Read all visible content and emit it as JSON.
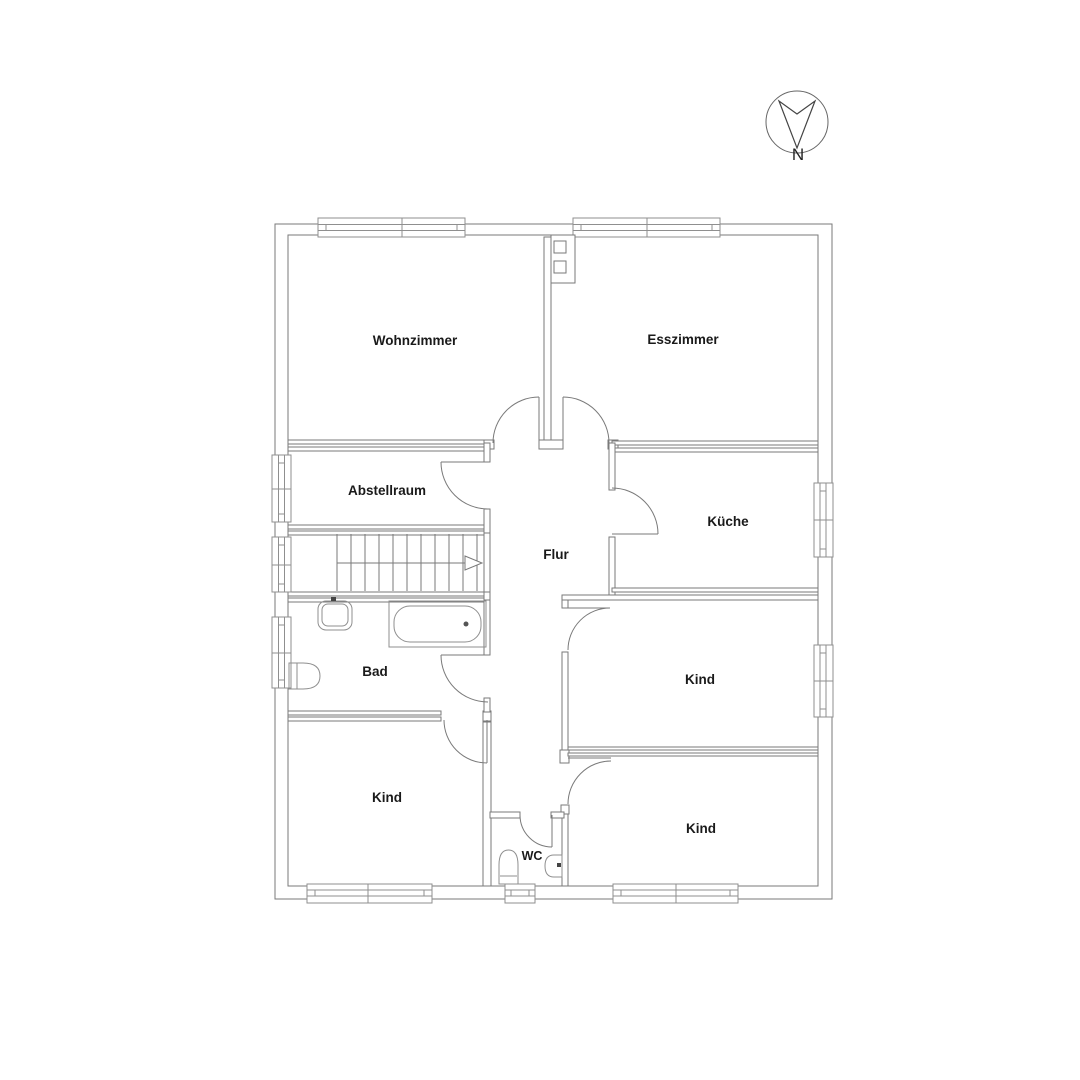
{
  "plan": {
    "rooms": [
      {
        "id": "wohnzimmer",
        "label": "Wohnzimmer"
      },
      {
        "id": "esszimmer",
        "label": "Esszimmer"
      },
      {
        "id": "abstellraum",
        "label": "Abstellraum"
      },
      {
        "id": "kueche",
        "label": "Küche"
      },
      {
        "id": "flur",
        "label": "Flur"
      },
      {
        "id": "bad",
        "label": "Bad"
      },
      {
        "id": "kind-left",
        "label": "Kind"
      },
      {
        "id": "kind-right-middle",
        "label": "Kind"
      },
      {
        "id": "kind-right-bottom",
        "label": "Kind"
      },
      {
        "id": "wc",
        "label": "WC"
      }
    ],
    "compass": {
      "label": "N"
    },
    "colors": {
      "wall_line": "#7a7a7a",
      "window_line": "#8f8f8f",
      "fixture_line": "#8f8f8f",
      "label_text": "#1a1a1a",
      "background": "#ffffff"
    }
  }
}
